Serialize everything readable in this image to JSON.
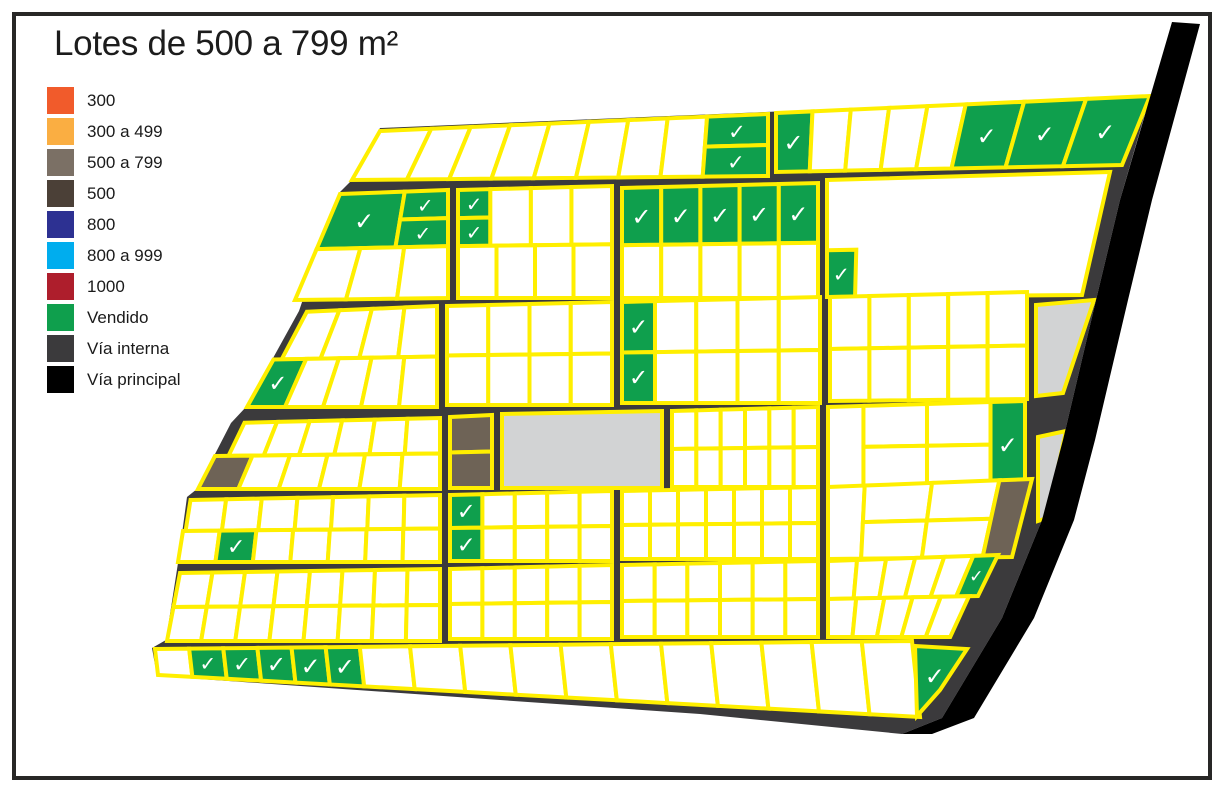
{
  "title": "Lotes de 500 a 799 m²",
  "legend": {
    "items": [
      {
        "label": "300",
        "color": "#f15b2b"
      },
      {
        "label": "300 a 499",
        "color": "#faae42"
      },
      {
        "label": "500 a 799",
        "color": "#7b7065"
      },
      {
        "label": "500",
        "color": "#4b4037"
      },
      {
        "label": "800",
        "color": "#2d3192"
      },
      {
        "label": "800 a 999",
        "color": "#00adee"
      },
      {
        "label": "1000",
        "color": "#ae1e2c"
      },
      {
        "label": "Vendido",
        "color": "#0f9f4d"
      },
      {
        "label": "Vía interna",
        "color": "#3b3a3c"
      },
      {
        "label": "Vía principal",
        "color": "#000000"
      }
    ]
  },
  "map": {
    "check_glyph": "✓",
    "palette": {
      "lot": "#ffffff",
      "outline": "#ffef00",
      "sold": "#0f9f4d",
      "lot_500_799": "#6e6356",
      "reserve": "#d2d3d4",
      "road_internal": "#3b3a3c",
      "road_main": "#000000",
      "check": "#ffffff",
      "frame": "#282726"
    },
    "estate": [
      [
        380,
        128
      ],
      [
        1150,
        96
      ],
      [
        1120,
        200
      ],
      [
        1096,
        300
      ],
      [
        1063,
        440
      ],
      [
        1042,
        520
      ],
      [
        1002,
        618
      ],
      [
        942,
        718
      ],
      [
        902,
        734
      ],
      [
        700,
        714
      ],
      [
        157,
        676
      ],
      [
        152,
        648
      ],
      [
        166,
        640
      ],
      [
        178,
        563
      ],
      [
        187,
        497
      ],
      [
        197,
        489
      ],
      [
        231,
        423
      ],
      [
        246,
        407
      ],
      [
        299,
        311
      ],
      [
        339,
        193
      ],
      [
        351,
        181
      ]
    ],
    "main_road": [
      [
        1172,
        22
      ],
      [
        1200,
        24
      ],
      [
        1152,
        200
      ],
      [
        1128,
        300
      ],
      [
        1095,
        440
      ],
      [
        1074,
        520
      ],
      [
        1034,
        618
      ],
      [
        974,
        718
      ],
      [
        932,
        734
      ],
      [
        902,
        734
      ],
      [
        942,
        718
      ],
      [
        1002,
        618
      ],
      [
        1042,
        520
      ],
      [
        1063,
        440
      ],
      [
        1096,
        300
      ],
      [
        1120,
        200
      ]
    ],
    "blocks": [
      {
        "id": "top-strip-west",
        "q": [
          380,
          131,
          768,
          114,
          768,
          176,
          352,
          180
        ],
        "rows": [
          {
            "y": [
              0,
              1
            ],
            "x": [
              0,
              0.843
            ],
            "w": [
              1.3,
              1,
              1,
              1,
              1,
              1,
              1,
              1
            ]
          },
          {
            "y": [
              0,
              0.5
            ],
            "x": [
              0.843,
              1
            ],
            "n": 1,
            "sold": [
              0
            ]
          },
          {
            "y": [
              0.5,
              1
            ],
            "x": [
              0.843,
              1
            ],
            "n": 1,
            "sold": [
              0
            ]
          }
        ]
      },
      {
        "id": "top-strip-east",
        "q": [
          776,
          113,
          1150,
          96,
          1122,
          165,
          776,
          172
        ],
        "rows": [
          {
            "y": [
              0,
              1
            ],
            "w": [
              1,
              1.05,
              1.05,
              1.05,
              1.05,
              1.6,
              1.7,
              1.75
            ],
            "sold": [
              0,
              5,
              6,
              7
            ]
          }
        ]
      },
      {
        "id": "row2-a",
        "q": [
          340,
          194,
          448,
          190,
          448,
          298,
          295,
          300
        ],
        "rows": [
          {
            "y": [
              0,
              0.52
            ],
            "x": [
              0,
              0.6
            ],
            "n": 1,
            "sold": [
              0
            ]
          },
          {
            "y": [
              0,
              0.26
            ],
            "x": [
              0.6,
              1
            ],
            "n": 1,
            "sold": [
              0
            ]
          },
          {
            "y": [
              0.26,
              0.52
            ],
            "x": [
              0.6,
              1
            ],
            "n": 1,
            "sold": [
              0
            ]
          },
          {
            "y": [
              0.52,
              1
            ],
            "n": 3
          }
        ]
      },
      {
        "id": "row2-b",
        "q": [
          458,
          190,
          612,
          186,
          612,
          298,
          458,
          298
        ],
        "rows": [
          {
            "y": [
              0,
              0.26
            ],
            "x": [
              0,
              0.21
            ],
            "n": 1,
            "sold": [
              0
            ]
          },
          {
            "y": [
              0.26,
              0.52
            ],
            "x": [
              0,
              0.21
            ],
            "n": 1,
            "sold": [
              0
            ]
          },
          {
            "y": [
              0,
              0.52
            ],
            "x": [
              0.21,
              1
            ],
            "n": 3
          },
          {
            "y": [
              0.52,
              1
            ],
            "n": 4
          }
        ]
      },
      {
        "id": "row2-c",
        "q": [
          622,
          188,
          818,
          183,
          818,
          298,
          622,
          298
        ],
        "rows": [
          {
            "y": [
              0,
              0.52
            ],
            "n": 5,
            "sold": [
              0,
              1,
              2,
              3,
              4
            ]
          },
          {
            "y": [
              0.52,
              1
            ],
            "n": 5
          }
        ]
      },
      {
        "id": "row2-d",
        "q": [
          827,
          180,
          1110,
          172,
          1082,
          295,
          827,
          297
        ],
        "rows": [
          {
            "y": [
              0,
              1
            ],
            "n": 1
          },
          {
            "y": [
              0.6,
              1
            ],
            "x": [
              0,
              0.11
            ],
            "n": 1,
            "sold": [
              0
            ]
          }
        ]
      },
      {
        "id": "row3-a",
        "q": [
          300,
          312,
          437,
          306,
          437,
          407,
          247,
          407
        ],
        "rows": [
          {
            "y": [
              0,
              0.5
            ],
            "x": [
              0.05,
              1
            ],
            "n": 4
          },
          {
            "y": [
              0.5,
              1
            ],
            "n": 5,
            "sold": [
              0
            ]
          }
        ]
      },
      {
        "id": "row3-b",
        "q": [
          447,
          306,
          612,
          302,
          612,
          405,
          447,
          405
        ],
        "rows": [
          {
            "y": [
              0,
              0.5
            ],
            "n": 4
          },
          {
            "y": [
              0.5,
              1
            ],
            "n": 4
          }
        ]
      },
      {
        "id": "row3-c",
        "q": [
          622,
          302,
          820,
          297,
          820,
          403,
          622,
          403
        ],
        "rows": [
          {
            "y": [
              0,
              0.5
            ],
            "w": [
              0.8,
              1,
              1,
              1,
              1
            ],
            "sold": [
              0
            ]
          },
          {
            "y": [
              0.5,
              1
            ],
            "w": [
              0.8,
              1,
              1,
              1,
              1
            ],
            "sold": [
              0
            ]
          }
        ]
      },
      {
        "id": "row3-d",
        "q": [
          830,
          297,
          1027,
          292,
          1027,
          399,
          830,
          401
        ],
        "rows": [
          {
            "y": [
              0,
              0.5
            ],
            "n": 5
          },
          {
            "y": [
              0.5,
              1
            ],
            "n": 5
          }
        ]
      },
      {
        "id": "row4-a",
        "q": [
          232,
          423,
          440,
          418,
          440,
          489,
          198,
          489
        ],
        "rows": [
          {
            "y": [
              0,
              0.5
            ],
            "x": [
              0.06,
              1
            ],
            "n": 6
          },
          {
            "y": [
              0.5,
              1
            ],
            "n": 6,
            "brown": [
              0
            ]
          }
        ]
      },
      {
        "id": "row4-b",
        "q": [
          450,
          417,
          492,
          415,
          492,
          488,
          450,
          488
        ],
        "rows": [
          {
            "y": [
              0,
              0.5
            ],
            "n": 1,
            "brown": [
              0
            ]
          },
          {
            "y": [
              0.5,
              1
            ],
            "n": 1,
            "brown": [
              0
            ]
          }
        ]
      },
      {
        "id": "row4-reserve",
        "q": [
          502,
          414,
          662,
          411,
          662,
          488,
          502,
          488
        ],
        "rows": [
          {
            "y": [
              0,
              1
            ],
            "n": 1,
            "gray": [
              0
            ]
          }
        ]
      },
      {
        "id": "row4-c",
        "q": [
          672,
          411,
          818,
          407,
          818,
          487,
          672,
          487
        ],
        "rows": [
          {
            "y": [
              0,
              0.5
            ],
            "n": 6
          },
          {
            "y": [
              0.5,
              1
            ],
            "n": 6
          }
        ]
      },
      {
        "id": "row4-d",
        "q": [
          828,
          407,
          1025,
          401,
          1025,
          487,
          828,
          488
        ],
        "rows": [
          {
            "y": [
              0,
              1
            ],
            "x": [
              0,
              0.18
            ],
            "n": 1
          },
          {
            "y": [
              0,
              0.5
            ],
            "x": [
              0.18,
              0.825
            ],
            "n": 2
          },
          {
            "y": [
              0.5,
              1
            ],
            "x": [
              0.18,
              0.825
            ],
            "n": 2
          },
          {
            "y": [
              0,
              1
            ],
            "x": [
              0.825,
              1
            ],
            "n": 1,
            "sold": [
              0
            ]
          }
        ]
      },
      {
        "id": "row5-a",
        "q": [
          188,
          500,
          440,
          495,
          440,
          562,
          178,
          562
        ],
        "rows": [
          {
            "y": [
              0,
              0.5
            ],
            "x": [
              0.01,
              1
            ],
            "n": 7
          },
          {
            "y": [
              0.5,
              1
            ],
            "n": 7,
            "sold": [
              1
            ]
          }
        ]
      },
      {
        "id": "row5-b",
        "q": [
          450,
          495,
          612,
          491,
          612,
          561,
          450,
          561
        ],
        "rows": [
          {
            "y": [
              0,
              0.5
            ],
            "x": [
              0,
              0.2
            ],
            "n": 1,
            "sold": [
              0
            ]
          },
          {
            "y": [
              0.5,
              1
            ],
            "x": [
              0,
              0.2
            ],
            "n": 1,
            "sold": [
              0
            ]
          },
          {
            "y": [
              0,
              0.5
            ],
            "x": [
              0.2,
              1
            ],
            "n": 4
          },
          {
            "y": [
              0.5,
              1
            ],
            "x": [
              0.2,
              1
            ],
            "n": 4
          }
        ]
      },
      {
        "id": "row5-c",
        "q": [
          622,
          491,
          818,
          487,
          818,
          559,
          622,
          559
        ],
        "rows": [
          {
            "y": [
              0,
              0.5
            ],
            "n": 7
          },
          {
            "y": [
              0.5,
              1
            ],
            "n": 7
          }
        ]
      },
      {
        "id": "row5-d",
        "q": [
          828,
          487,
          1032,
          479,
          1012,
          557,
          828,
          559
        ],
        "rows": [
          {
            "y": [
              0,
              1
            ],
            "x": [
              0,
              0.18
            ],
            "n": 1
          },
          {
            "y": [
              0,
              0.5
            ],
            "x": [
              0.18,
              0.84
            ],
            "n": 2
          },
          {
            "y": [
              0.5,
              1
            ],
            "x": [
              0.18,
              0.84
            ],
            "n": 2
          },
          {
            "y": [
              0,
              1
            ],
            "x": [
              0.84,
              1
            ],
            "n": 1,
            "brown": [
              0
            ]
          }
        ]
      },
      {
        "id": "row6-a",
        "q": [
          180,
          573,
          440,
          569,
          440,
          641,
          167,
          641
        ],
        "rows": [
          {
            "y": [
              0,
              0.5
            ],
            "n": 8
          },
          {
            "y": [
              0.5,
              1
            ],
            "n": 8
          }
        ]
      },
      {
        "id": "row6-b",
        "q": [
          450,
          569,
          612,
          565,
          612,
          639,
          450,
          639
        ],
        "rows": [
          {
            "y": [
              0,
              0.5
            ],
            "n": 5
          },
          {
            "y": [
              0.5,
              1
            ],
            "n": 5
          }
        ]
      },
      {
        "id": "row6-c",
        "q": [
          622,
          565,
          818,
          561,
          818,
          637,
          622,
          637
        ],
        "rows": [
          {
            "y": [
              0,
              0.5
            ],
            "n": 6
          },
          {
            "y": [
              0.5,
              1
            ],
            "n": 6
          }
        ]
      },
      {
        "id": "row6-d",
        "q": [
          828,
          561,
          998,
          555,
          958,
          637,
          828,
          637
        ],
        "rows": [
          {
            "y": [
              0,
              0.5
            ],
            "w": [
              1,
              1,
              1,
              1,
              1,
              0.85
            ],
            "sold": [
              5
            ]
          },
          {
            "y": [
              0.5,
              1
            ],
            "x": [
              0,
              0.94
            ],
            "n": 5
          }
        ]
      },
      {
        "id": "bottom-strip",
        "q": [
          155,
          649,
          912,
          641,
          920,
          717,
          158,
          675
        ],
        "rows": [
          {
            "y": [
              0,
              1
            ],
            "w": [
              0.68,
              0.68,
              0.68,
              0.68,
              0.68,
              0.68,
              1,
              1,
              1,
              1,
              1,
              1,
              1,
              1,
              1,
              1,
              1
            ],
            "sold": [
              1,
              2,
              3,
              4,
              5
            ]
          }
        ]
      }
    ],
    "extras": [
      {
        "id": "reserve-east-upper",
        "pts": [
          [
            1036,
            305
          ],
          [
            1094,
            300
          ],
          [
            1063,
            393
          ],
          [
            1036,
            396
          ]
        ],
        "fill": "gray"
      },
      {
        "id": "reserve-east-lower",
        "pts": [
          [
            1038,
            437
          ],
          [
            1066,
            431
          ],
          [
            1047,
            518
          ],
          [
            1038,
            521
          ]
        ],
        "fill": "gray"
      },
      {
        "id": "sold-south-east",
        "pts": [
          [
            915,
            646
          ],
          [
            967,
            649
          ],
          [
            940,
            690
          ],
          [
            917,
            716
          ]
        ],
        "fill": "sold",
        "check": true
      }
    ]
  }
}
